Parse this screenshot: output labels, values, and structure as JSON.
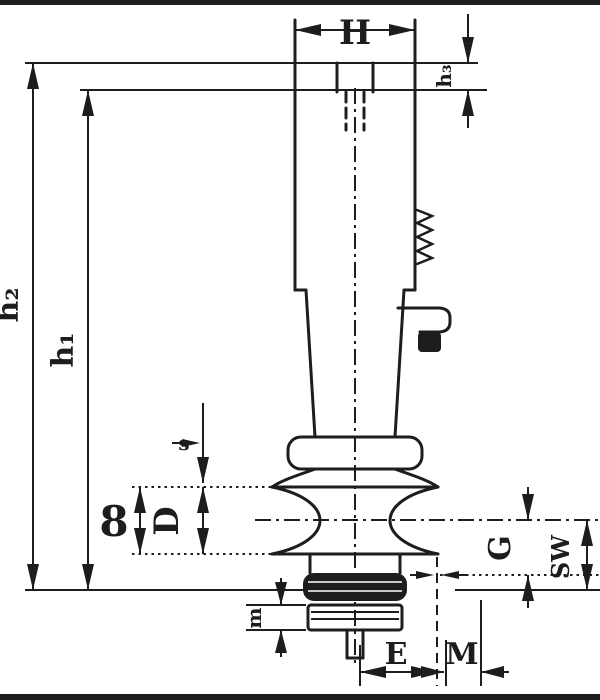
{
  "figure": {
    "type": "technical-drawing",
    "background": "#ffffff",
    "line_color": "#1d1d1b",
    "labels": {
      "top_width": "H",
      "top_right_height": "h₃",
      "left_outer_height": "h₂",
      "left_inner_height": "h₁",
      "collar_thickness": "s",
      "mid_left_outer": "8",
      "mid_left_inner": "D",
      "right_inner": "G",
      "right_outer": "SW",
      "bottom_left_height": "m",
      "bottom_width_inner": "E",
      "bottom_width_outer": "M"
    }
  }
}
